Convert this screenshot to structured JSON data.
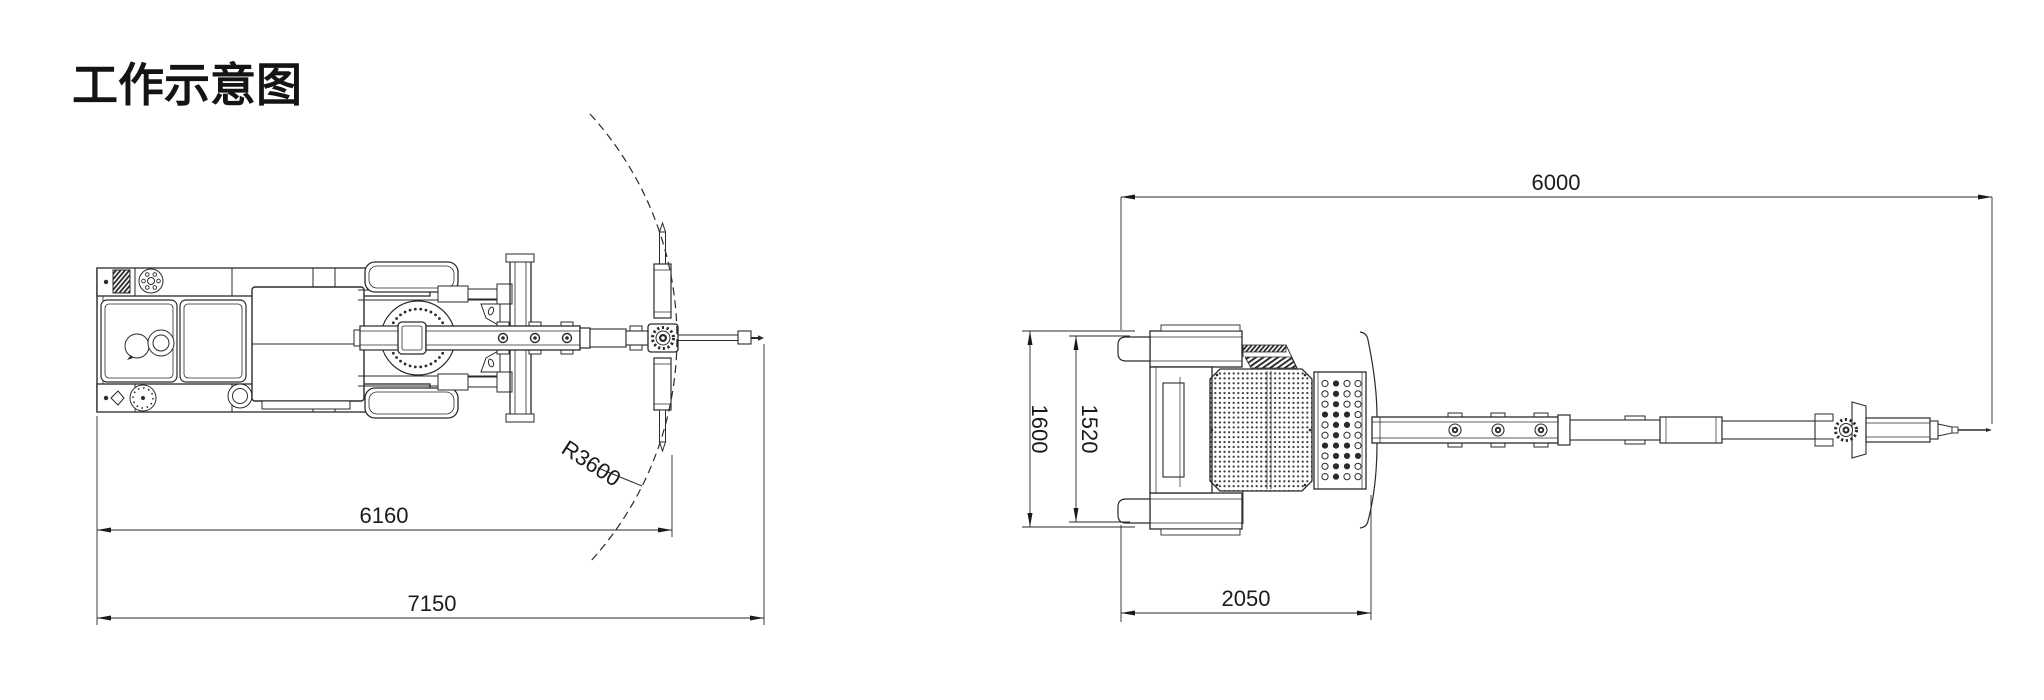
{
  "title": "工作示意图",
  "colors": {
    "background": "#ffffff",
    "line": "#2b2a29",
    "text": "#1b1b1a"
  },
  "left_view": {
    "description": "plan-view of crawler drill rig with swing arc",
    "dims": {
      "working_length": "6160",
      "total_length": "7150",
      "swing_radius": "R3600"
    }
  },
  "right_view": {
    "description": "plan-view of rig travelling position",
    "dims": {
      "overall_length": "6000",
      "track_width": "1600",
      "inner_width": "1520",
      "rear_length": "2050"
    }
  },
  "grille_pattern": [
    [
      0,
      1,
      0,
      0
    ],
    [
      0,
      1,
      0,
      0
    ],
    [
      0,
      1,
      0,
      0
    ],
    [
      1,
      1,
      1,
      0
    ],
    [
      0,
      1,
      1,
      0
    ],
    [
      0,
      1,
      0,
      0
    ],
    [
      1,
      1,
      1,
      0
    ],
    [
      0,
      1,
      1,
      1
    ],
    [
      0,
      1,
      1,
      0
    ],
    [
      0,
      1,
      0,
      0
    ]
  ],
  "turntable_dots": 34,
  "flange_holes": 6
}
